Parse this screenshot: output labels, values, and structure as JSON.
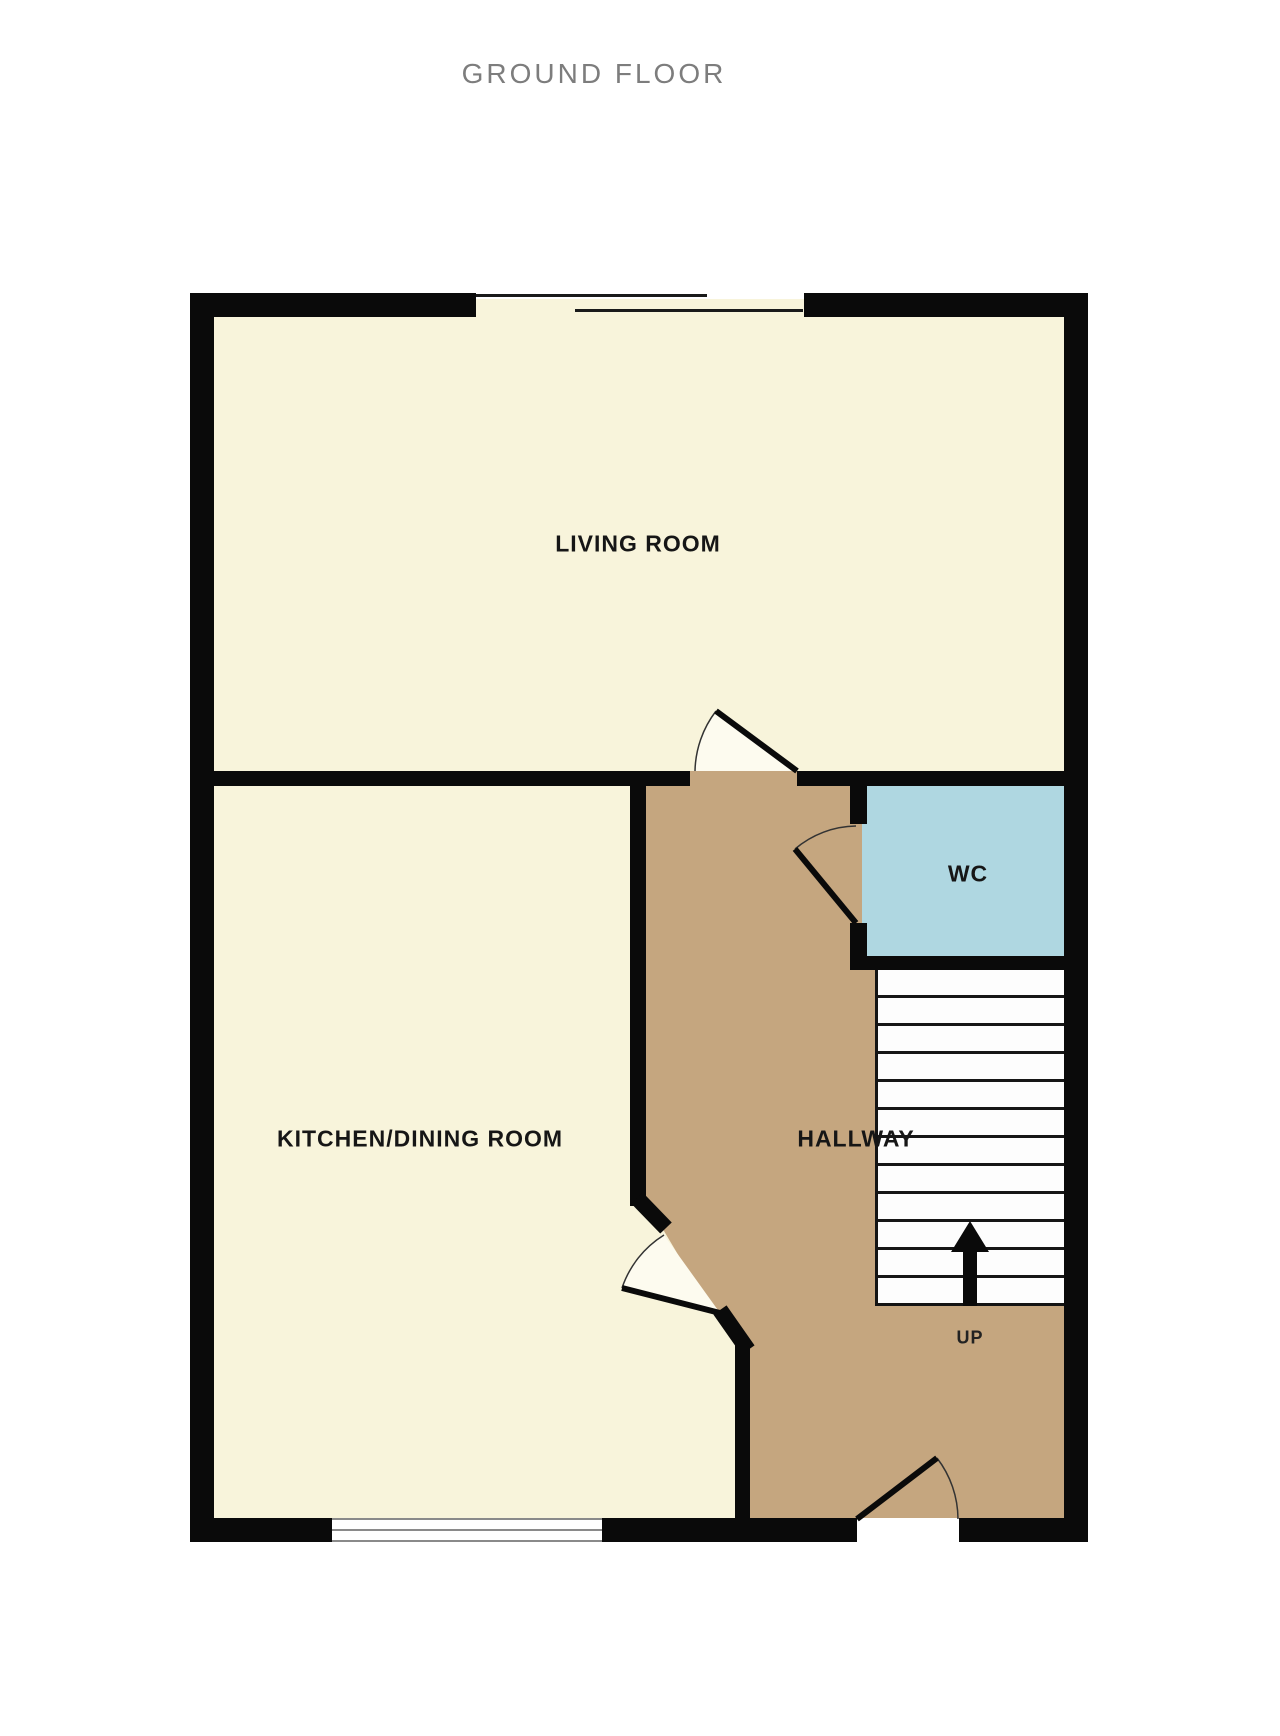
{
  "plan": {
    "title": "GROUND FLOOR",
    "labels": {
      "living_room": "LIVING ROOM",
      "kitchen_dining": "KITCHEN/DINING ROOM",
      "hallway": "HALLWAY",
      "wc": "WC",
      "stairs_direction": "UP"
    },
    "stairs": {
      "step_count": 12
    },
    "colors": {
      "room_floor": "#F8F4DB",
      "hallway_floor": "#C5A67F",
      "wc_floor": "#AFD7E1",
      "wall": "#0A0A0A",
      "door_swing": "#FDFBEF",
      "title_text": "#7D7D7D",
      "label_text": "#161616"
    }
  }
}
